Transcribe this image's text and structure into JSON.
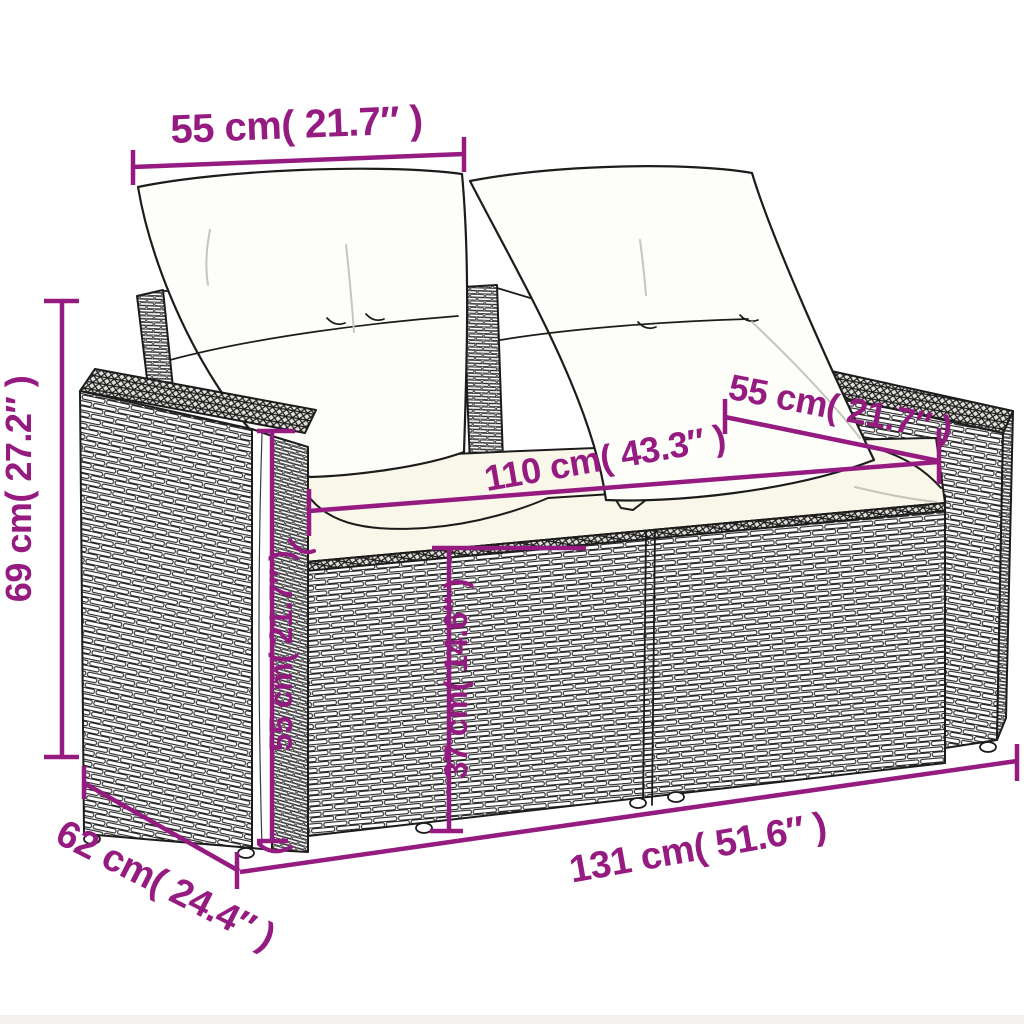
{
  "page": {
    "background": "#ffffff",
    "bottom_strip_color": "#f2f1ef"
  },
  "diagram": {
    "accent_color": "#951B81",
    "line_color": "#1c1c1c",
    "dims": {
      "back_cushion_width": {
        "label": "55 cm( 21.7″ )"
      },
      "overall_height": {
        "label": "69 cm( 27.2″ )"
      },
      "armrest_depth": {
        "label": "55 cm( 21.7″ )"
      },
      "seat_width": {
        "label": "110 cm( 43.3″ )"
      },
      "frame_height": {
        "label": "55 cm( 21.7″ )"
      },
      "seat_height": {
        "label": "37 cm( 14.6″ )"
      },
      "overall_width": {
        "label": "131 cm( 51.6″ )"
      },
      "overall_depth": {
        "label": "62 cm( 24.4″ )"
      }
    }
  }
}
